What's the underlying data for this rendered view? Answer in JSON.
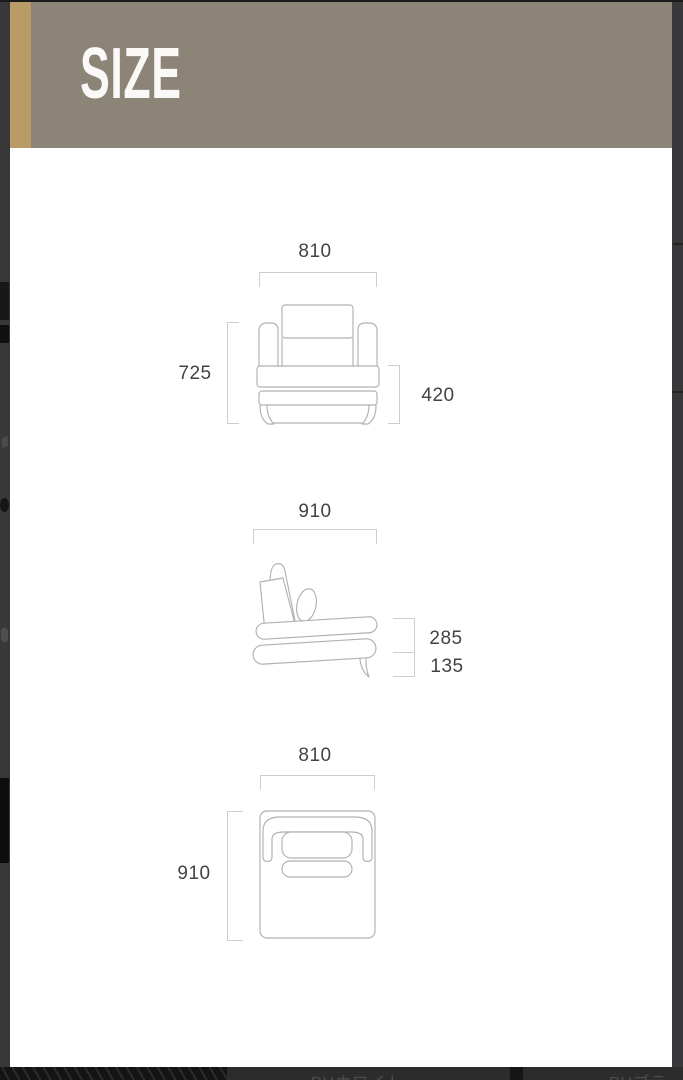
{
  "title": "SIZE",
  "diagram": {
    "front": {
      "width": "810",
      "height": "725",
      "seat_height": "420"
    },
    "side": {
      "depth": "910",
      "seat_section_height": "285",
      "leg_clearance": "135"
    },
    "top": {
      "width": "810",
      "depth": "910"
    }
  },
  "background_page": {
    "center_label": "PUホワイト",
    "right_label": "PUブラ"
  },
  "colors": {
    "header_bg": "#8d8478",
    "accent_stripe": "#b89b66",
    "frame_dark": "#38383a",
    "dimension_line": "#cdcdcd",
    "drawing_stroke": "#b2b1ae",
    "label_text": "#434343"
  }
}
